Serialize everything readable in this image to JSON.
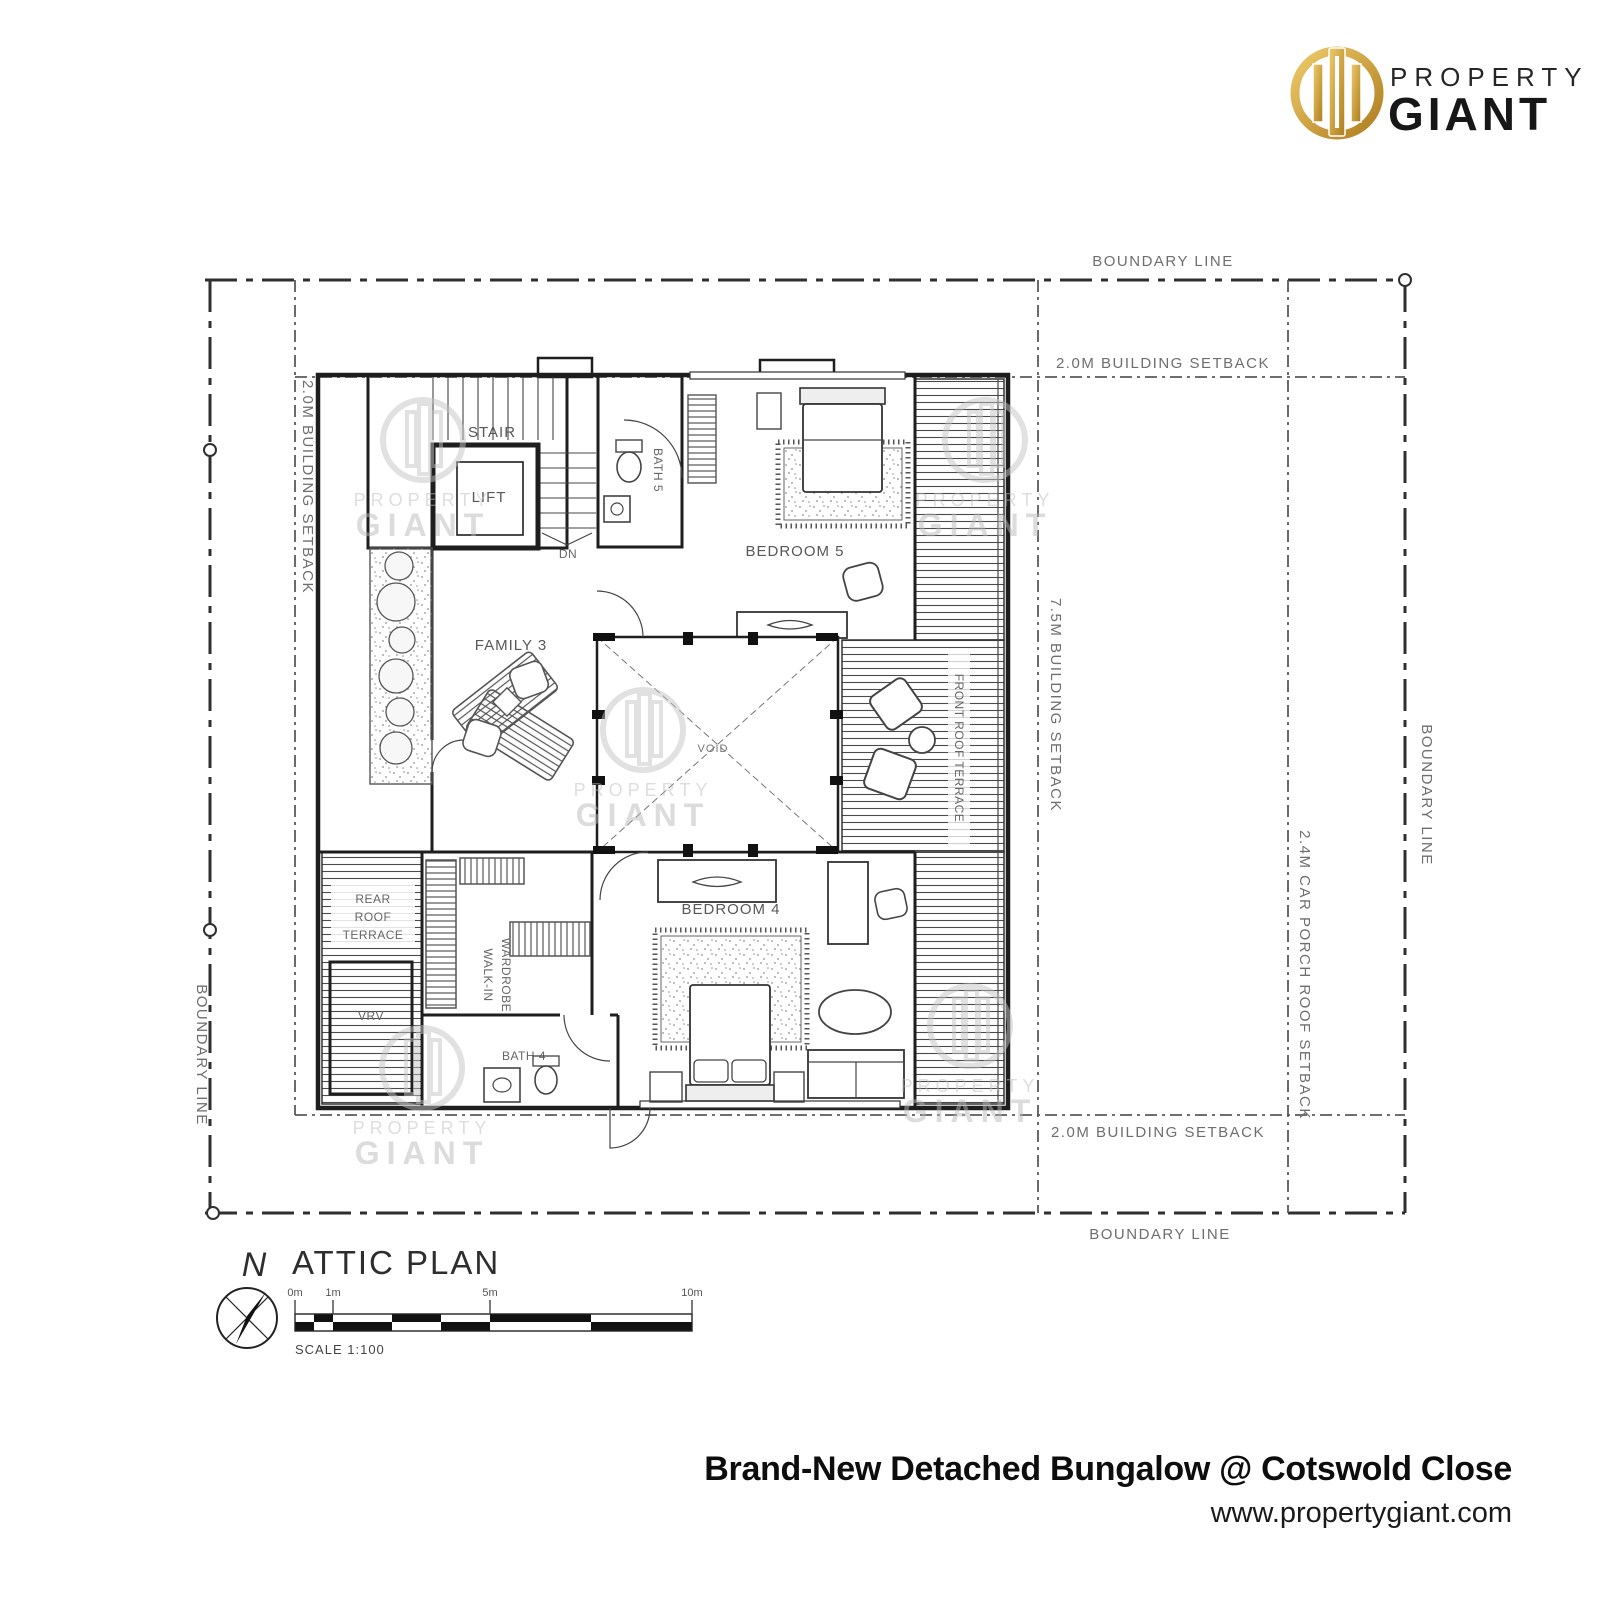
{
  "brand": {
    "word1": "PROPERTY",
    "word2": "GIANT"
  },
  "watermark": {
    "word1": "PROPERTY",
    "word2": "GIANT"
  },
  "plan": {
    "title": "ATTIC PLAN",
    "north": "N",
    "scale_text": "SCALE 1:100",
    "ticks": [
      "0m",
      "1m",
      "5m",
      "10m"
    ],
    "boundary_top": "BOUNDARY LINE",
    "boundary_bottom": "BOUNDARY LINE",
    "boundary_left": "BOUNDARY LINE",
    "boundary_right": "BOUNDARY LINE",
    "setback_top": "2.0M BUILDING SETBACK",
    "setback_left": "2.0M BUILDING SETBACK",
    "setback_bottom": "2.0M BUILDING SETBACK",
    "setback_front": "7.5M BUILDING SETBACK",
    "setback_carporch": "2.4M CAR PORCH ROOF SETBACK",
    "rooms": {
      "stair": "STAIR",
      "lift": "LIFT",
      "dn": "DN",
      "bath5": "BATH 5",
      "bedroom5": "BEDROOM 5",
      "family": "FAMILY 3",
      "void": "VOID",
      "front_terrace": "FRONT ROOF TERRACE",
      "rear_terrace": [
        "REAR",
        "ROOF",
        "TERRACE"
      ],
      "vrv": "VRV",
      "wardrobe": [
        "WALK-IN",
        "WARDROBE"
      ],
      "bath4": "BATH 4",
      "bedroom4": "BEDROOM 4"
    }
  },
  "footer": {
    "title": "Brand-New Detached Bungalow @ Cotswold Close",
    "website": "www.propertygiant.com"
  },
  "colors": {
    "gold": "#C9A13B",
    "gold_light": "#EECB6B",
    "gold_dark": "#AE7D1E",
    "ink": "#1e1e1e",
    "line_gray": "#555555",
    "label_gray": "#6e6e6e",
    "watermark_gray": "#bdbdbd"
  }
}
